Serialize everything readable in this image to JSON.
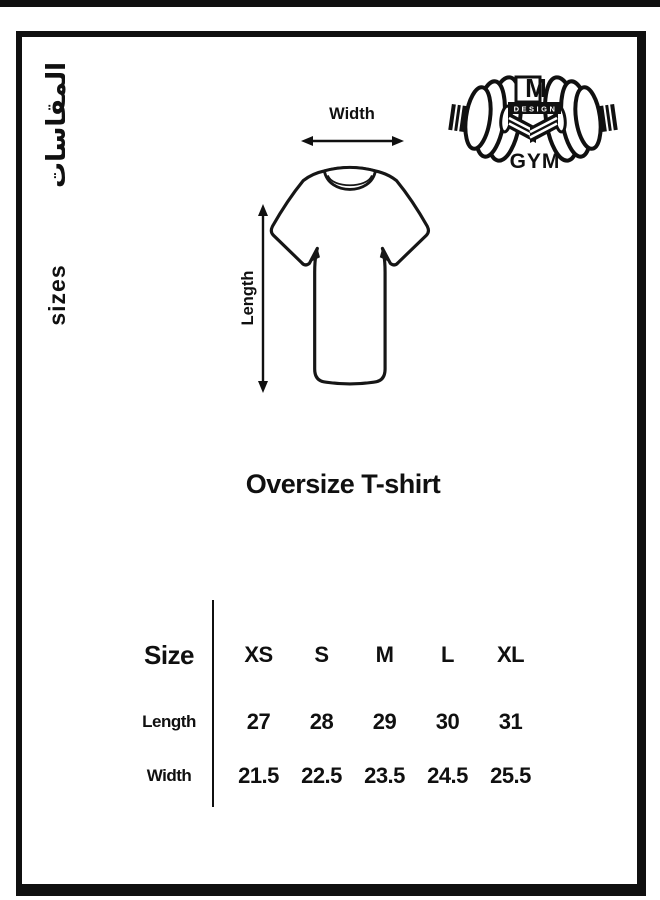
{
  "colors": {
    "ink": "#101010",
    "background": "#ffffff"
  },
  "side_labels": {
    "arabic": "المقاسات",
    "english": "sizes"
  },
  "diagram": {
    "width_label": "Width",
    "length_label": "Length"
  },
  "logo": {
    "monogram": "M",
    "design_text": "DESIGN",
    "gym_text": "GYM"
  },
  "title": "Oversize T-shirt",
  "size_table": {
    "corner_header": "Size",
    "columns": [
      "XS",
      "S",
      "M",
      "L",
      "XL"
    ],
    "rows": [
      {
        "label": "Length",
        "values": [
          "27",
          "28",
          "29",
          "30",
          "31"
        ]
      },
      {
        "label": "Width",
        "values": [
          "21.5",
          "22.5",
          "23.5",
          "24.5",
          "25.5"
        ]
      }
    ]
  },
  "chart_data": {
    "type": "table",
    "title": "Oversize T-shirt",
    "columns": [
      "XS",
      "S",
      "M",
      "L",
      "XL"
    ],
    "rows": [
      {
        "label": "Length",
        "values": [
          27,
          28,
          29,
          30,
          31
        ]
      },
      {
        "label": "Width",
        "values": [
          21.5,
          22.5,
          23.5,
          24.5,
          25.5
        ]
      }
    ]
  }
}
